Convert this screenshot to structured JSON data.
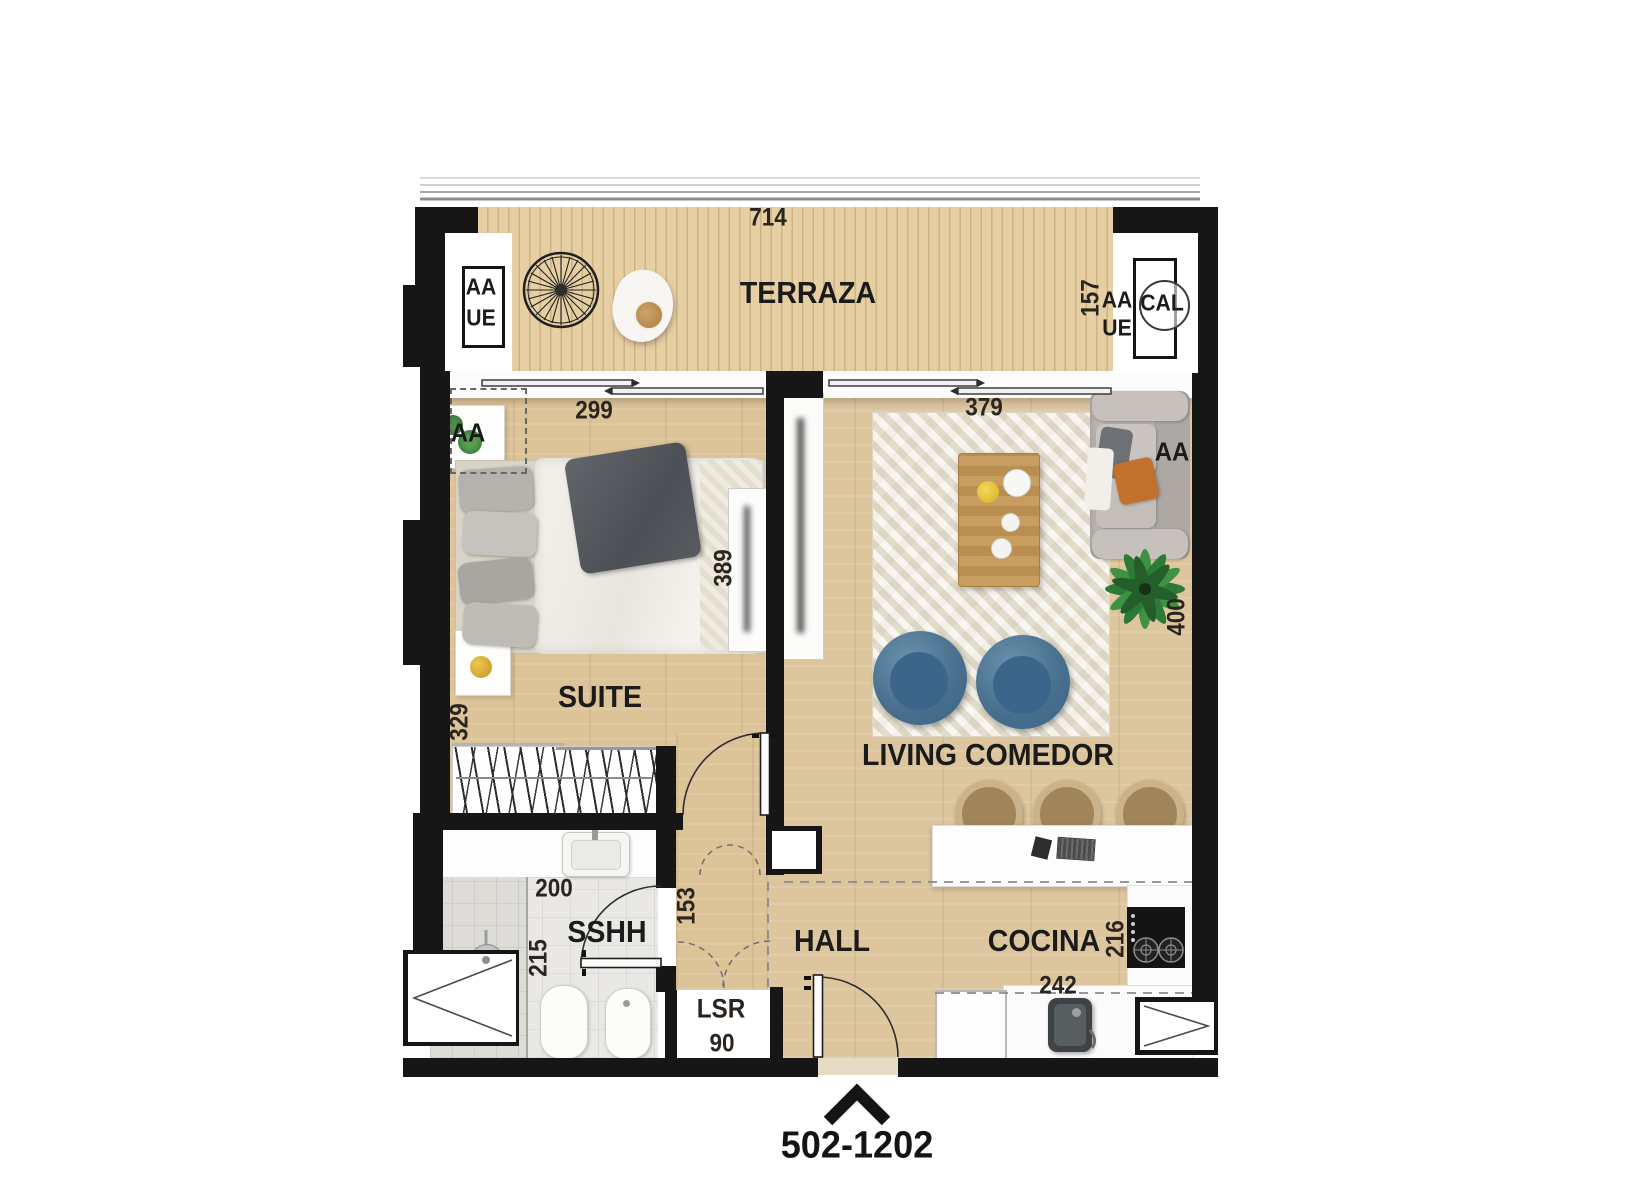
{
  "unit": {
    "label": "502-1202"
  },
  "rooms": {
    "terraza": "TERRAZA",
    "suite": "SUITE",
    "living": "LIVING COMEDOR",
    "bathroom": "SSHH",
    "hall": "HALL",
    "kitchen": "COCINA",
    "laundry": "LSR"
  },
  "dimensions": {
    "terraza_width": "714",
    "terraza_depth": "157",
    "suite_window": "299",
    "living_window": "379",
    "suite_depth": "389",
    "living_depth": "400",
    "suite_side": "329",
    "bath_width": "200",
    "bath_depth": "215",
    "corridor_depth": "153",
    "kitchen_depth": "216",
    "kitchen_width": "242",
    "laundry_width": "90"
  },
  "labels": {
    "ac_left_top": "AA",
    "ac_left_bottom": "UE",
    "ac_right_top": "AA",
    "ac_right_bottom": "UE",
    "heater": "CAL",
    "ac_suite": "AA",
    "ac_living": "AA"
  },
  "colors": {
    "wall": "#161616",
    "deck_wood": "#e2cb9e",
    "floor_wood": "#dcc398",
    "rug": "#ece6d6",
    "bath_tile": "#e9e8e4",
    "accent_chair_blue": "#49718e",
    "sofa_gray": "#bdb7b3",
    "table_wood": "#c59a5d",
    "plant_green": "#2c7a35",
    "pillow_orange": "#c2702e",
    "cooktop_black": "#141414"
  }
}
